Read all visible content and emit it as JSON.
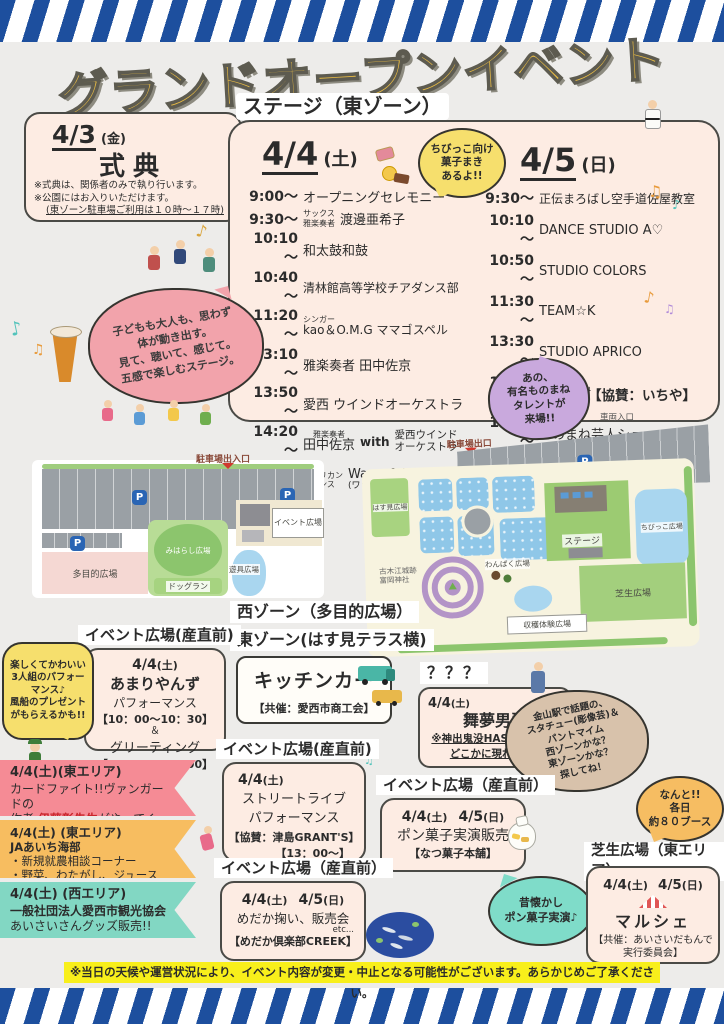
{
  "title": "グランドオープンイベント",
  "colors": {
    "stripe_blue": "#1d4f9e",
    "title_gold": "#e9bc45",
    "panel_pink": "#fdece3",
    "bubble_yellow": "#f6df6d",
    "bubble_purple": "#c9a9dd",
    "bubble_pink": "#f2a3ab",
    "bubble_tan": "#d8c2ab",
    "bubble_teal": "#7fdcc9",
    "ribbon_pink": "#f58b95",
    "ribbon_orange": "#f7bd60",
    "ribbon_teal": "#82d7c3",
    "note_yellow": "#f8ef1b",
    "highlight_red": "#d03a2e"
  },
  "ceremony": {
    "date": "4/3",
    "dow": "(金)",
    "name": "式典",
    "note1": "※式典は、関係者のみで執り行います。",
    "note2": "※公園にはお入りいただけます。",
    "note3": "(東ゾーン駐車場ご利用は１０時～１７時)"
  },
  "stage": {
    "header": "ステージ（東ゾーン）",
    "candy_bubble": "ちびっこ向け\n菓子まき\nあるよ!!",
    "stage_bubble": "子どもも大人も、思わず\n体が動き出す。\n見て、聴いて、感じて。\n五感で楽しむステージ。",
    "impersonator_bubble": "あの、\n有名ものまね\nタレントが\n来場!!",
    "day1": {
      "date": "4/4",
      "dow": "(土)",
      "rows": [
        {
          "time": "9:00～",
          "name": "オープニングセレモニー"
        },
        {
          "time": "9:30～",
          "ann": "サックス\n雅楽奏者",
          "name": "渡邊亜希子"
        },
        {
          "time": "10:10～",
          "name": "和太鼓和鼓"
        },
        {
          "time": "10:40～",
          "name": "清林館高等学校チアダンス部"
        },
        {
          "time": "11:20～",
          "ann": "シンガー",
          "name": "kao＆O.M.G ママゴスペル"
        },
        {
          "time": "13:10～",
          "name": "雅楽奏者 田中佐京"
        },
        {
          "time": "13:50～",
          "name": "愛西 ウインドオーケストラ"
        },
        {
          "time": "14:20～",
          "ann": "雅楽奏者",
          "name": "田中佐京",
          "mid": "with",
          "tail": "愛西ウインド\nオーケストラ"
        },
        {
          "time": "15:10～",
          "ann": "アフリカン\nダンス",
          "name": "Wassafoli",
          "tail": "(ワッサフォリ)"
        }
      ]
    },
    "day2": {
      "date": "4/5",
      "dow": "(日)",
      "rows": [
        {
          "time": "9:30～",
          "name": "正伝まろばし空手道佐屋教室"
        },
        {
          "time": "10:10～",
          "name": "DANCE STUDIO A♡"
        },
        {
          "time": "10:50～",
          "name": "STUDIO COLORS"
        },
        {
          "time": "11:30～",
          "name": "TEAM☆K"
        },
        {
          "time": "13:30～",
          "name": "STUDIO APRICO"
        },
        {
          "time": "14:10～",
          "name": "神谷英樹"
        },
        {
          "time": "15:00～",
          "name": "ものまね芸人ショー"
        }
      ],
      "show_names": "『かいやまと』『ゆうや裕夜』",
      "sponsor": "【協賛：いちや】"
    }
  },
  "map": {
    "p": "P",
    "west": {
      "entrance": "駐車場出入口",
      "tamokuteki": "多目的広場",
      "miharashi": "みはらし広場",
      "dogrun": "ドッグラン",
      "yugu": "遊具広場",
      "event_plaza": "イベント広場"
    },
    "east": {
      "exit": "駐車場出口",
      "vehicle": "車両入口",
      "hasumi": "はす見広場",
      "stage": "ステージ",
      "chibikko": "ちびっこ広場",
      "shibafu": "芝生広場",
      "wanpaku": "わんぱく広場",
      "harvest": "収穫体験広場",
      "shrine": "古木江城跡\n富岡神社"
    }
  },
  "zones": {
    "west_label": "西ゾーン（多目的広場）",
    "east_label": "東ゾーン(はす見テラス横)"
  },
  "kitchen_car": {
    "title": "キッチンカー",
    "sponsor": "【共催：愛西市商工会】"
  },
  "amariyanzu": {
    "location": "イベント広場(産直前)",
    "date": "4/4",
    "dow": "(土)",
    "name": "あまりやんず",
    "line1": "パフォーマンス",
    "line2": "【10：00～10：30】",
    "line3": "＆",
    "line4": "グリーティング",
    "line5": "【10：40～11：00】",
    "bubble": "楽しくてかわいい\n3人組のパフォー\nマンス♪\n風船のプレゼント\nがもらえるかも!!"
  },
  "mystery": {
    "label": "？？？",
    "date": "4/4",
    "dow": "(土)",
    "name": "舞夢男爵",
    "line1": "※神出鬼没HASUパーク内",
    "line2": "どこかに現れるよ♪",
    "bubble": "金山駅で話題の、\nスタチュー(彫像芸)＆\nパントマイム\n西ゾーンかな？\n東ゾーンかな？\n探してね！"
  },
  "ribbons": [
    {
      "line1": "4/4(土)(東エリア)",
      "line2": "カードファイト!!ヴァンガードの",
      "line3_pre": "作者",
      "line3_em": "伊藤彰先生",
      "line3_post": "がやってくる!!"
    },
    {
      "line1": "4/4(土) (東エリア)",
      "line2": "JAあいち海部",
      "line3": "・新規就農相談コーナー",
      "line4": "・野菜、わたがし、ジュース販売"
    },
    {
      "line1": "4/4(土) (西エリア)",
      "line2": "一般社団法人愛西市観光協会",
      "line3": "あいさいさんグッズ販売!!"
    }
  ],
  "street_live": {
    "location": "イベント広場(産直前)",
    "date": "4/4",
    "dow": "(土)",
    "line1": "ストリートライブ",
    "line2": "パフォーマンス",
    "line3": "【協賛：津島GRANT'S】",
    "line4": "【13：00～】"
  },
  "pon_gashi": {
    "location": "イベント広場（産直前）",
    "date1": "4/4",
    "dow1": "(土)",
    "date2": "4/5",
    "dow2": "(日)",
    "line1": "ポン菓子実演販売",
    "line2": "【なつ菓子本舗】",
    "bubble": "昔懐かし\nポン菓子実演♪"
  },
  "medaka": {
    "location": "イベント広場（産直前）",
    "date1": "4/4",
    "dow1": "(土)",
    "date2": "4/5",
    "dow2": "(日)",
    "line1": "めだか掬い、販売会",
    "etc": "etc...",
    "line2": "【めだか倶楽部CREEK】"
  },
  "marche": {
    "location": "芝生広場（東エリア）",
    "date1": "4/4",
    "dow1": "(土)",
    "date2": "4/5",
    "dow2": "(日)",
    "name": "マルシェ",
    "sponsor": "【共催：あいさいだもんで\n実行委員会】",
    "booth_bubble": "なんと!!\n各日\n約８０ブース"
  },
  "footer_note": "※当日の天候や運営状況により、イベント内容が変更・中止となる可能性がございます。あらかじめご了承ください。"
}
